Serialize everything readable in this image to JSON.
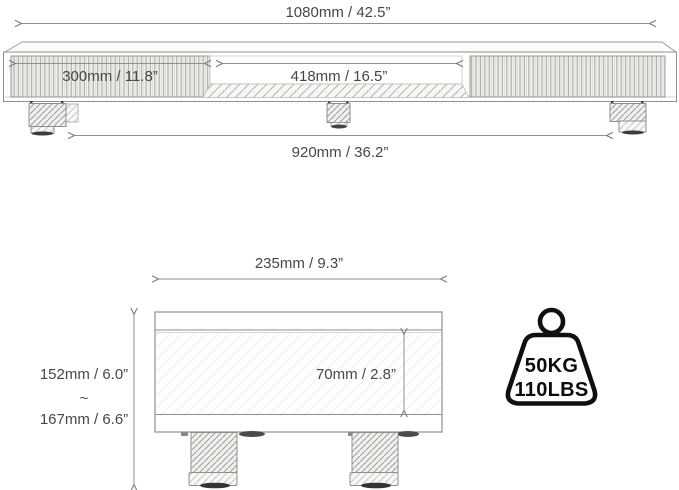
{
  "front_view": {
    "overall_width": "1080mm / 42.5”",
    "left_compartment_width": "300mm / 11.8”",
    "middle_compartment_width": "418mm / 16.5”",
    "leg_span": "920mm / 36.2”"
  },
  "side_view": {
    "depth": "235mm / 9.3”",
    "height_min": "152mm / 6.0”",
    "height_separator": "~",
    "height_max": "167mm / 6.6”",
    "shelf_inner_height": "70mm / 2.8”"
  },
  "weight_capacity": {
    "kg": "50KG",
    "lbs": "110LBS"
  },
  "colors": {
    "line_gray": "#8f8f8f",
    "text_gray": "#474747",
    "icon_black": "#101010"
  }
}
